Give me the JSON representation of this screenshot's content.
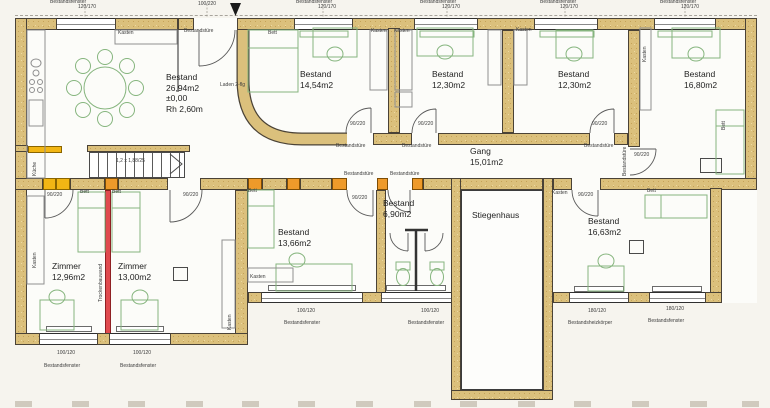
{
  "drawing": {
    "type": "floor-plan-scan",
    "language": "de"
  },
  "colors": {
    "existing_wall_tan": "#dbc07c",
    "new_partition_red": "#e04a4e",
    "new_block_orange": "#ee9a2a",
    "new_block_yellow": "#f2b614",
    "furniture_green": "#86b57e"
  },
  "rooms": [
    {
      "id": "bestand-2694",
      "lines": [
        "Bestand",
        "26,94m2",
        "±0,00",
        "Rh 2,60m"
      ],
      "x": 166,
      "y": 72
    },
    {
      "id": "bestand-1454",
      "lines": [
        "Bestand",
        "14,54m2"
      ],
      "x": 300,
      "y": 69
    },
    {
      "id": "bestand-1230-a",
      "lines": [
        "Bestand",
        "12,30m2"
      ],
      "x": 432,
      "y": 69
    },
    {
      "id": "bestand-1230-b",
      "lines": [
        "Bestand",
        "12,30m2"
      ],
      "x": 558,
      "y": 69
    },
    {
      "id": "bestand-1680",
      "lines": [
        "Bestand",
        "16,80m2"
      ],
      "x": 684,
      "y": 69
    },
    {
      "id": "gang",
      "lines": [
        "Gang",
        "15,01m2"
      ],
      "x": 470,
      "y": 146
    },
    {
      "id": "zimmer-1296",
      "lines": [
        "Zimmer",
        "12,96m2"
      ],
      "x": 52,
      "y": 261
    },
    {
      "id": "zimmer-1300",
      "lines": [
        "Zimmer",
        "13,00m2"
      ],
      "x": 118,
      "y": 261
    },
    {
      "id": "bestand-1366",
      "lines": [
        "Bestand",
        "13,66m2"
      ],
      "x": 278,
      "y": 227
    },
    {
      "id": "bestand-690",
      "lines": [
        "Bestand",
        "6,90m2"
      ],
      "x": 383,
      "y": 198
    },
    {
      "id": "stiegenhaus",
      "lines": [
        "Stiegenhaus"
      ],
      "x": 472,
      "y": 210
    },
    {
      "id": "bestand-1663",
      "lines": [
        "Bestand",
        "16,63m2"
      ],
      "x": 588,
      "y": 216
    }
  ],
  "micro_labels": [
    {
      "t": "Bestandsfenster",
      "x": 50,
      "y": 0
    },
    {
      "t": "120/170",
      "x": 78,
      "y": 5
    },
    {
      "t": "100/220",
      "x": 198,
      "y": 2
    },
    {
      "t": "Bestandsfenster",
      "x": 296,
      "y": 0
    },
    {
      "t": "120/170",
      "x": 318,
      "y": 5
    },
    {
      "t": "Bestandsfenster",
      "x": 420,
      "y": 0
    },
    {
      "t": "120/170",
      "x": 442,
      "y": 5
    },
    {
      "t": "Bestandsfenster",
      "x": 540,
      "y": 0
    },
    {
      "t": "120/170",
      "x": 560,
      "y": 5
    },
    {
      "t": "Bestandsfenster",
      "x": 660,
      "y": 0
    },
    {
      "t": "120/170",
      "x": 681,
      "y": 5
    },
    {
      "t": "Bestandstüre",
      "x": 184,
      "y": 29
    },
    {
      "t": "Kasten",
      "x": 118,
      "y": 31
    },
    {
      "t": "Bett",
      "x": 268,
      "y": 31
    },
    {
      "t": "Laden 2-flg",
      "x": 220,
      "y": 83
    },
    {
      "t": "Kasten",
      "x": 371,
      "y": 29
    },
    {
      "t": "Kasten",
      "x": 394,
      "y": 29
    },
    {
      "t": "Kasten",
      "x": 516,
      "y": 28
    },
    {
      "t": "Kasten",
      "x": 643,
      "y": 62,
      "r": 1
    },
    {
      "t": "Bett",
      "x": 722,
      "y": 130,
      "r": 1
    },
    {
      "t": "90/220",
      "x": 350,
      "y": 122
    },
    {
      "t": "90/220",
      "x": 418,
      "y": 122
    },
    {
      "t": "90/220",
      "x": 592,
      "y": 122
    },
    {
      "t": "Bestandstüre",
      "x": 336,
      "y": 144
    },
    {
      "t": "Bestandstüre",
      "x": 402,
      "y": 144
    },
    {
      "t": "Bestandstüre",
      "x": 584,
      "y": 144
    },
    {
      "t": "Bestandstüre",
      "x": 623,
      "y": 176,
      "r": 1
    },
    {
      "t": "90/220",
      "x": 634,
      "y": 153
    },
    {
      "t": "Bestandstüre",
      "x": 344,
      "y": 172
    },
    {
      "t": "Bestandstüre",
      "x": 390,
      "y": 172
    },
    {
      "t": "Bett",
      "x": 80,
      "y": 190
    },
    {
      "t": "Bett",
      "x": 112,
      "y": 190
    },
    {
      "t": "Bett",
      "x": 248,
      "y": 189
    },
    {
      "t": "Bett",
      "x": 647,
      "y": 189
    },
    {
      "t": "90/220",
      "x": 47,
      "y": 193
    },
    {
      "t": "90/220",
      "x": 183,
      "y": 193
    },
    {
      "t": "90/220",
      "x": 352,
      "y": 196
    },
    {
      "t": "90/220",
      "x": 578,
      "y": 193
    },
    {
      "t": "Kasten",
      "x": 552,
      "y": 191
    },
    {
      "t": "Küche",
      "x": 33,
      "y": 176,
      "r": 1
    },
    {
      "t": "Kasten",
      "x": 33,
      "y": 268,
      "r": 1
    },
    {
      "t": "Kasten",
      "x": 228,
      "y": 330,
      "r": 1
    },
    {
      "t": "Kasten",
      "x": 250,
      "y": 275
    },
    {
      "t": "Trockenbauwand",
      "x": 99,
      "y": 302,
      "r": 1
    },
    {
      "t": "1,2 x 1,88/25",
      "x": 116,
      "y": 159
    },
    {
      "t": "Bestandsfenster",
      "x": 44,
      "y": 364
    },
    {
      "t": "100/120",
      "x": 57,
      "y": 351
    },
    {
      "t": "Bestandsfenster",
      "x": 120,
      "y": 364
    },
    {
      "t": "100/120",
      "x": 133,
      "y": 351
    },
    {
      "t": "Bestandsfenster",
      "x": 284,
      "y": 321
    },
    {
      "t": "100/120",
      "x": 297,
      "y": 309
    },
    {
      "t": "Bestandsfenster",
      "x": 408,
      "y": 321
    },
    {
      "t": "100/120",
      "x": 421,
      "y": 309
    },
    {
      "t": "Bestandsheizkörper",
      "x": 568,
      "y": 321
    },
    {
      "t": "180/120",
      "x": 588,
      "y": 309
    },
    {
      "t": "Bestandsfenster",
      "x": 648,
      "y": 319
    },
    {
      "t": "180/120",
      "x": 666,
      "y": 307
    }
  ]
}
